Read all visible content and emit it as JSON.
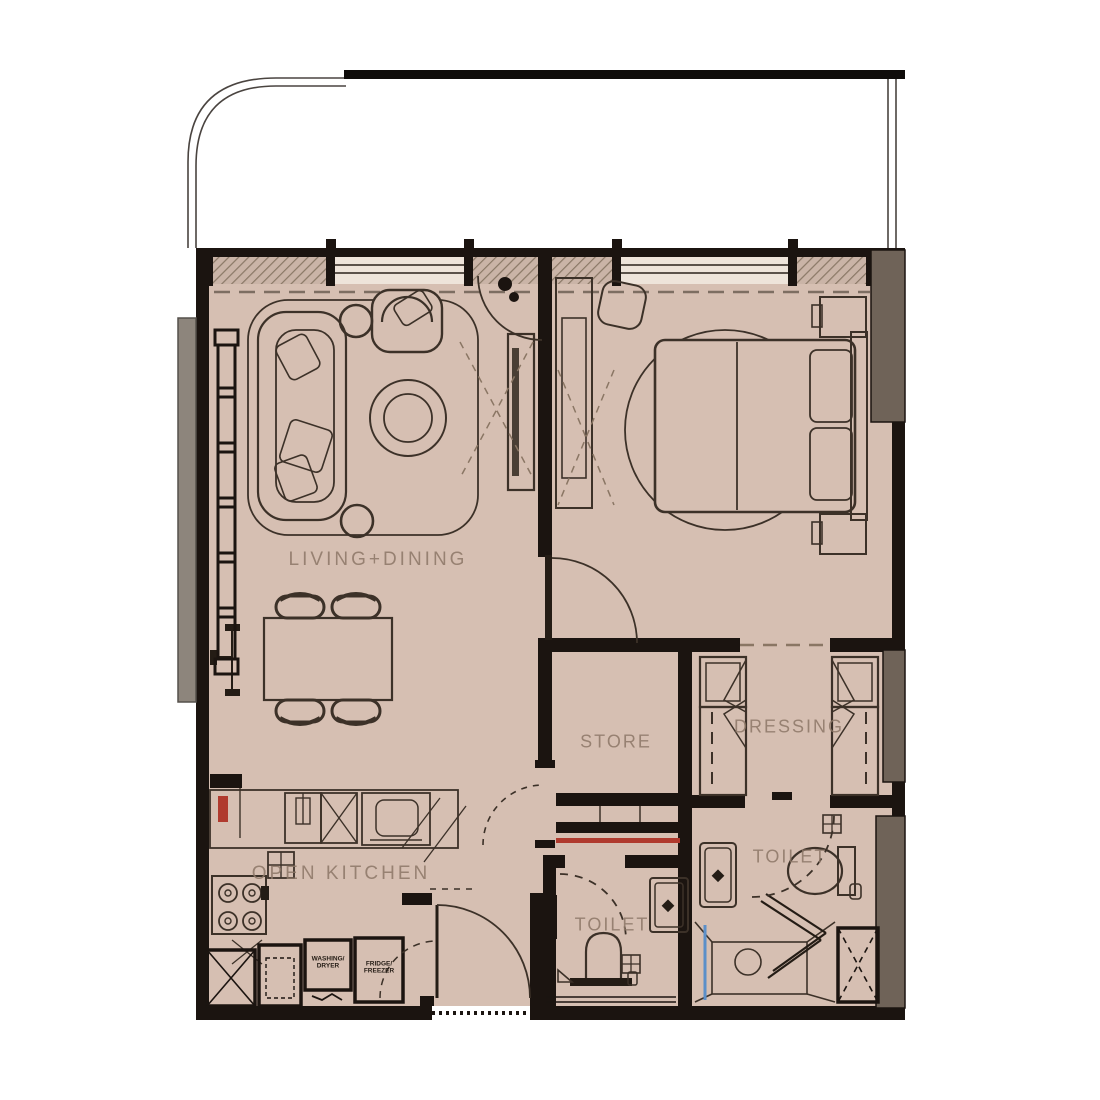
{
  "plan": {
    "title": "one-bedroom apartment floor plan",
    "rooms": {
      "living": {
        "label": "LIVING+DINING"
      },
      "store": {
        "label": "STORE"
      },
      "dressing": {
        "label": "DRESSING"
      },
      "toilet_master": {
        "label": "TOILET"
      },
      "toilet_common": {
        "label": "TOILET"
      },
      "kitchen": {
        "label": "OPEN KITCHEN"
      }
    },
    "appliances": {
      "washer": {
        "label": "WASHING/\nDRYER"
      },
      "fridge": {
        "label": "FRIDGE/\nFREEZER"
      }
    },
    "colors": {
      "floor": "#d6bfb2",
      "wall": "#1b1410",
      "line": "#3c3128",
      "label": "#8d7767",
      "column": "#6f6358",
      "outer_band": "#8d857c",
      "accent_red": "#b03a2e",
      "glass_blue": "#5b8fc9",
      "hatch": "#8a7866"
    }
  }
}
